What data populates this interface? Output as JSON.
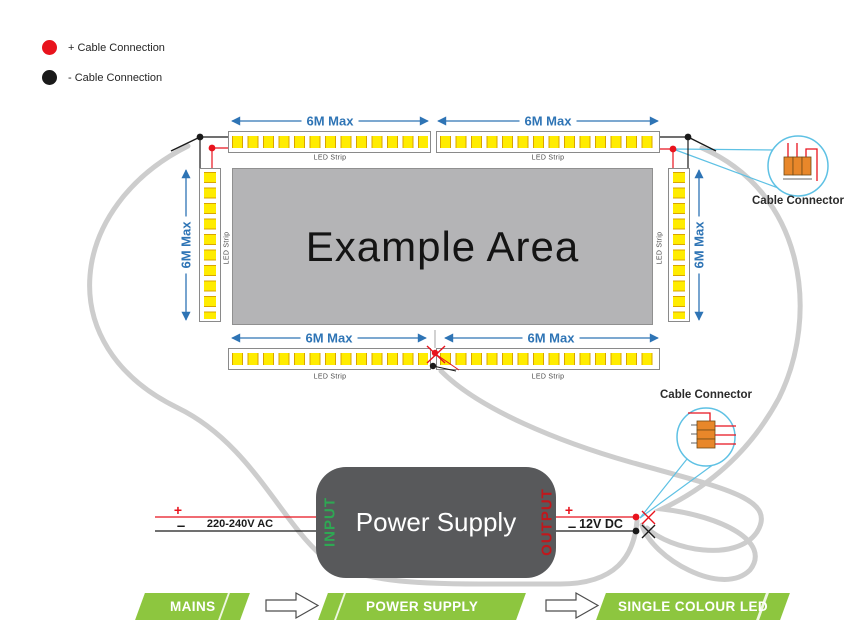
{
  "legend": {
    "items": [
      {
        "label": "+ Cable Connection",
        "color": "#e8131d"
      },
      {
        "label": "- Cable Connection",
        "color": "#1a1a1a"
      }
    ]
  },
  "example_area": {
    "label": "Example Area"
  },
  "dimension_label": "6M Max",
  "led_strip_label": "LED Strip",
  "cable_connector_label": "Cable Connector",
  "power_supply": {
    "title": "Power Supply",
    "input": "INPUT",
    "output": "OUTPUT",
    "ac": "220-240V AC",
    "dc": "12V DC",
    "plus": "+",
    "minus": "–"
  },
  "flow_steps": [
    {
      "label": "MAINS"
    },
    {
      "label": "POWER SUPPLY"
    },
    {
      "label": "SINGLE COLOUR LED"
    }
  ],
  "colors": {
    "banner_green": "#8dc63f",
    "dimension_blue": "#2e74b5",
    "wire_red": "#e8131d",
    "wire_black": "#1a1a1a",
    "cable_gray": "#cdcdcd",
    "callout_cyan": "#5ec1e4",
    "power_supply_gray": "#58595b",
    "led_yellow": "#ffec00",
    "area_gray": "#b4b4b6",
    "connector_orange": "#e8872a"
  }
}
